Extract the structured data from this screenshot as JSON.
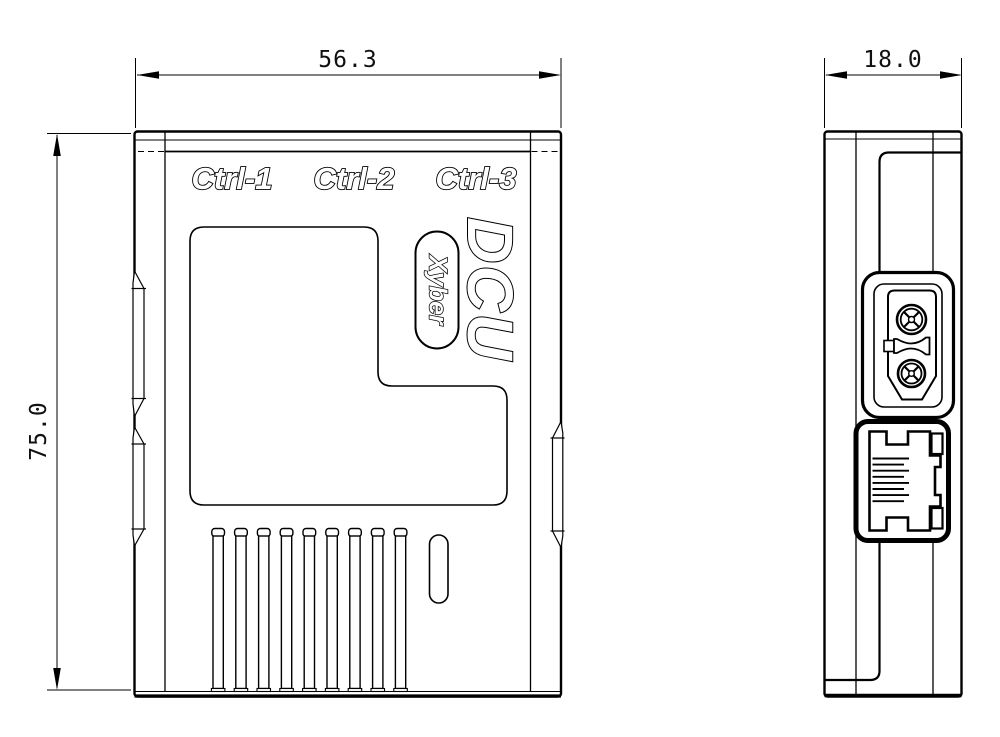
{
  "front_view": {
    "port_labels": [
      "Ctrl-1",
      "Ctrl-2",
      "Ctrl-3"
    ],
    "product_name": "DCU",
    "brand_name": "Xyber",
    "width_mm": "56.3",
    "height_mm": "75.0",
    "vent_count": 9
  },
  "side_view": {
    "depth_mm": "18.0",
    "rj45_pin_count": 8
  },
  "colors": {
    "line": "#000000",
    "background": "#ffffff"
  }
}
